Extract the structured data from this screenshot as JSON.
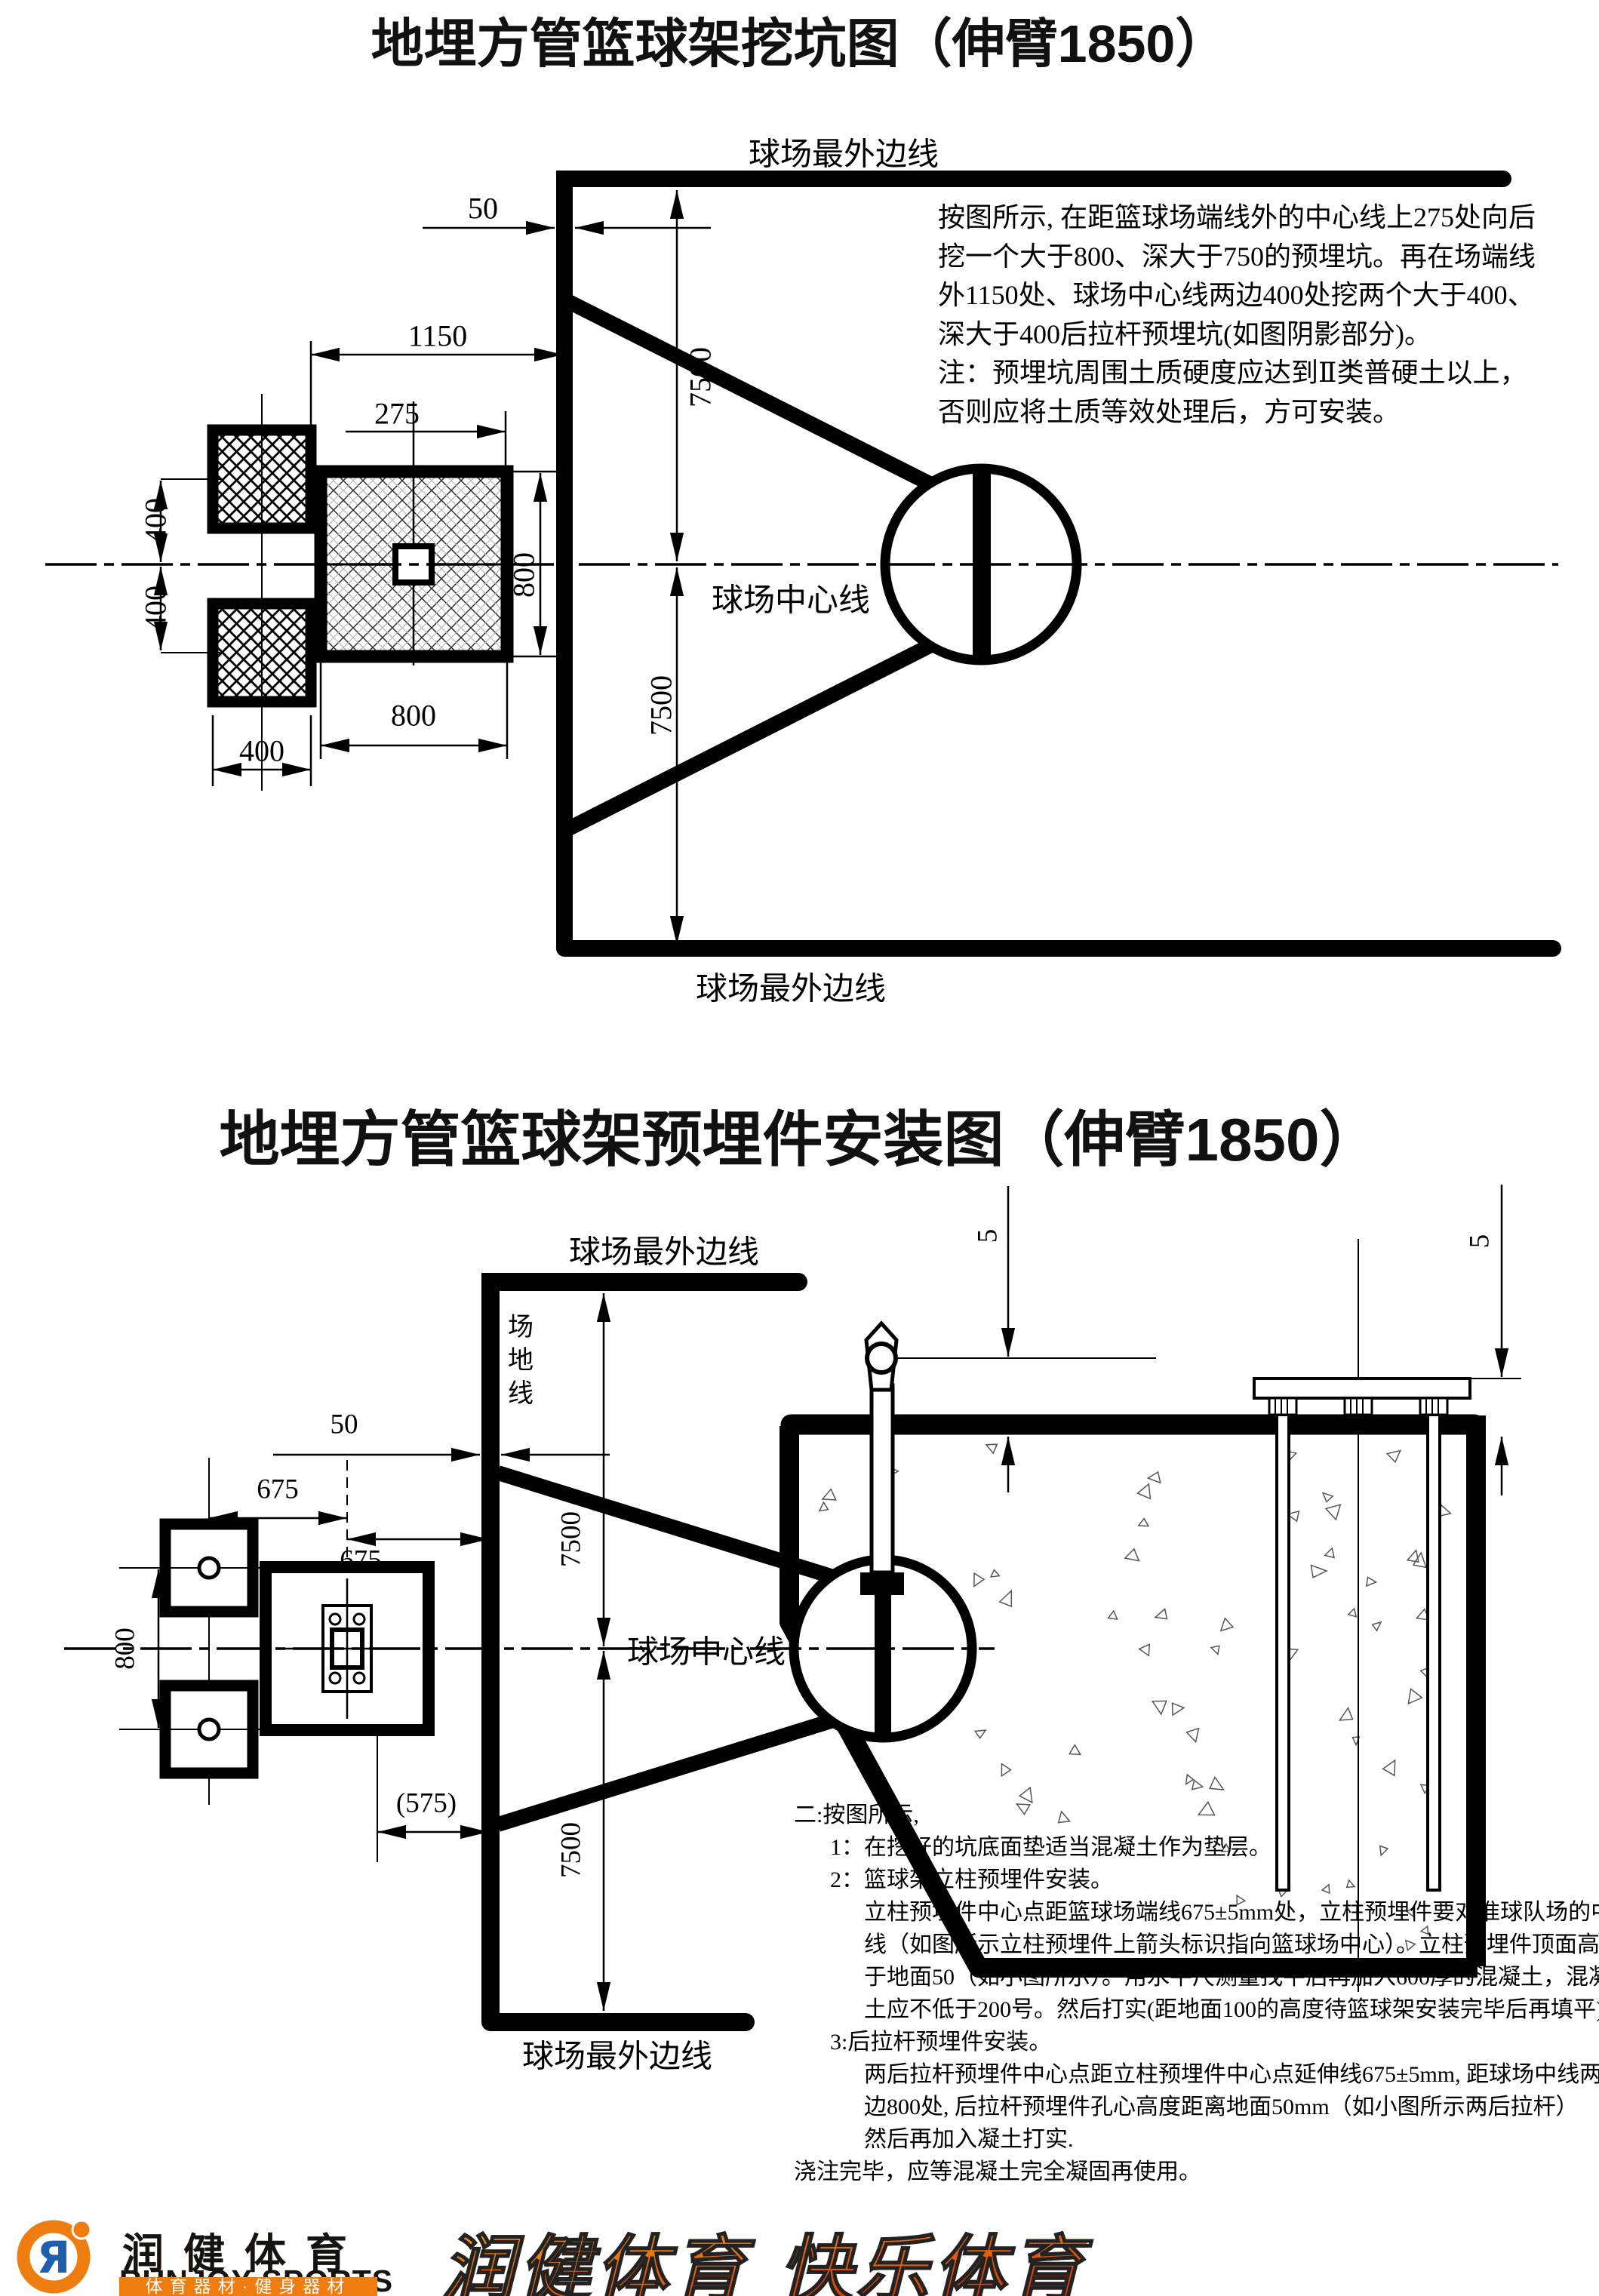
{
  "top_diagram": {
    "title": "地埋方管篮球架挖坑图（伸臂1850）",
    "labels": {
      "outer_line_top": "球场最外边线",
      "outer_line_bottom": "球场最外边线",
      "center_line": "球场中心线"
    },
    "dims": {
      "d50": "50",
      "d1150": "1150",
      "d275": "275",
      "d7500_upper": "7500",
      "d7500_lower": "7500",
      "d400_left_upper": "400",
      "d400_left_lower": "400",
      "d400_bottom": "400",
      "d800_bottom": "800",
      "d800_right": "800"
    },
    "note_lines": [
      "按图所示, 在距篮球场端线外的中心线上275处向后",
      "挖一个大于800、深大于750的预埋坑。再在场端线",
      "外1150处、球场中心线两边400处挖两个大于400、",
      "深大于400后拉杆预埋坑(如图阴影部分)。",
      "注：预埋坑周围土质硬度应达到Ⅱ类普硬土以上，",
      "否则应将土质等效处理后，方可安装。"
    ]
  },
  "bottom_diagram": {
    "title": "地埋方管篮球架预埋件安装图（伸臂1850）",
    "labels": {
      "outer_line_top": "球场最外边线",
      "outer_line_bottom": "球场最外边线",
      "center_line": "球场中心线",
      "field_line": "场地线"
    },
    "dims": {
      "d50": "50",
      "d675_a": "675",
      "d675_b": "675",
      "d800_left": "800",
      "d575": "(575)",
      "d7500_upper": "7500",
      "d7500_lower": "7500",
      "d5_left": "5",
      "d5_right": "5"
    },
    "instructions": [
      {
        "text": "二:按图所示,"
      },
      {
        "text": "1：在挖好的坑底面垫适当混凝土作为垫层。"
      },
      {
        "text": "2：篮球架立柱预埋件安装。"
      },
      {
        "text": "立柱预埋件中心点距篮球场端线675±5mm处，立柱预埋件要对准球队场的中"
      },
      {
        "text": "线（如图所示立柱预埋件上箭头标识指向篮球场中心）。立柱预埋件顶面高"
      },
      {
        "text": "于地面50（如小图所示）。用水平尺测量找平后再加入600厚的混凝土，混凝"
      },
      {
        "text": "土应不低于200号。然后打实(距地面100的高度待篮球架安装完毕后再填平)。"
      },
      {
        "text": "3:后拉杆预埋件安装。"
      },
      {
        "text": "两后拉杆预埋件中心点距立柱预埋件中心点延伸线675±5mm, 距球场中线两"
      },
      {
        "text": "边800处, 后拉杆预埋件孔心高度距离地面50mm（如小图所示两后拉杆）"
      },
      {
        "text": "然后再加入凝土打实."
      },
      {
        "text": "浇注完毕，应等混凝土完全凝固再使用。"
      }
    ]
  },
  "logo": {
    "mark_letter": "Я",
    "cn_name": "润健体育",
    "en_name": "RUNJOY SPORTS",
    "tagline": "体育器材·健身器材",
    "slogan": "润健体育 快乐体育",
    "colors": {
      "orange": "#ef7c0e",
      "blue": "#1f5fae",
      "red": "#cf2406",
      "black": "#000000"
    }
  }
}
